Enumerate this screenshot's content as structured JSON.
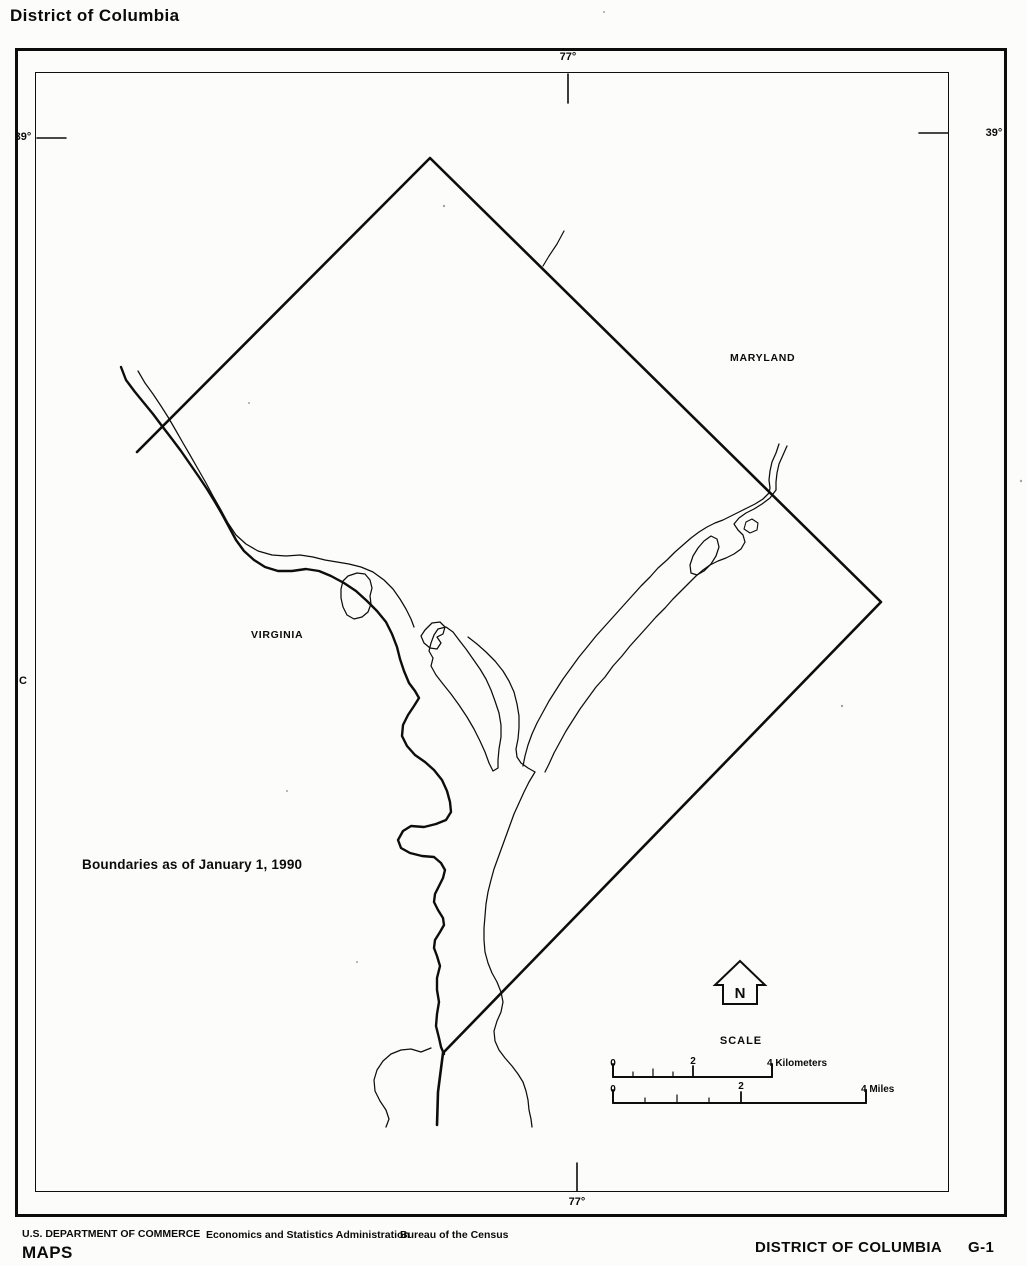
{
  "title": "District of Columbia",
  "map": {
    "graticule": {
      "top_lon": "77°",
      "bottom_lon": "77°",
      "left_lat": "39°",
      "right_lat": "39°",
      "row_index": "C"
    },
    "regions": {
      "maryland": "MARYLAND",
      "virginia": "VIRGINIA"
    },
    "note": "Boundaries as of January 1, 1990",
    "north_arrow_label": "N",
    "scale": {
      "title": "SCALE",
      "kilometers": {
        "zero": "0",
        "two": "2",
        "four": "4 Kilometers"
      },
      "miles": {
        "zero": "0",
        "two": "2",
        "four": "4 Miles"
      }
    }
  },
  "footer": {
    "department": "U.S. DEPARTMENT OF COMMERCE",
    "administration": "Economics and Statistics Administration",
    "bureau": "Bureau of the Census",
    "series": "MAPS",
    "sheet_title": "DISTRICT OF COLUMBIA",
    "sheet_number": "G-1"
  }
}
